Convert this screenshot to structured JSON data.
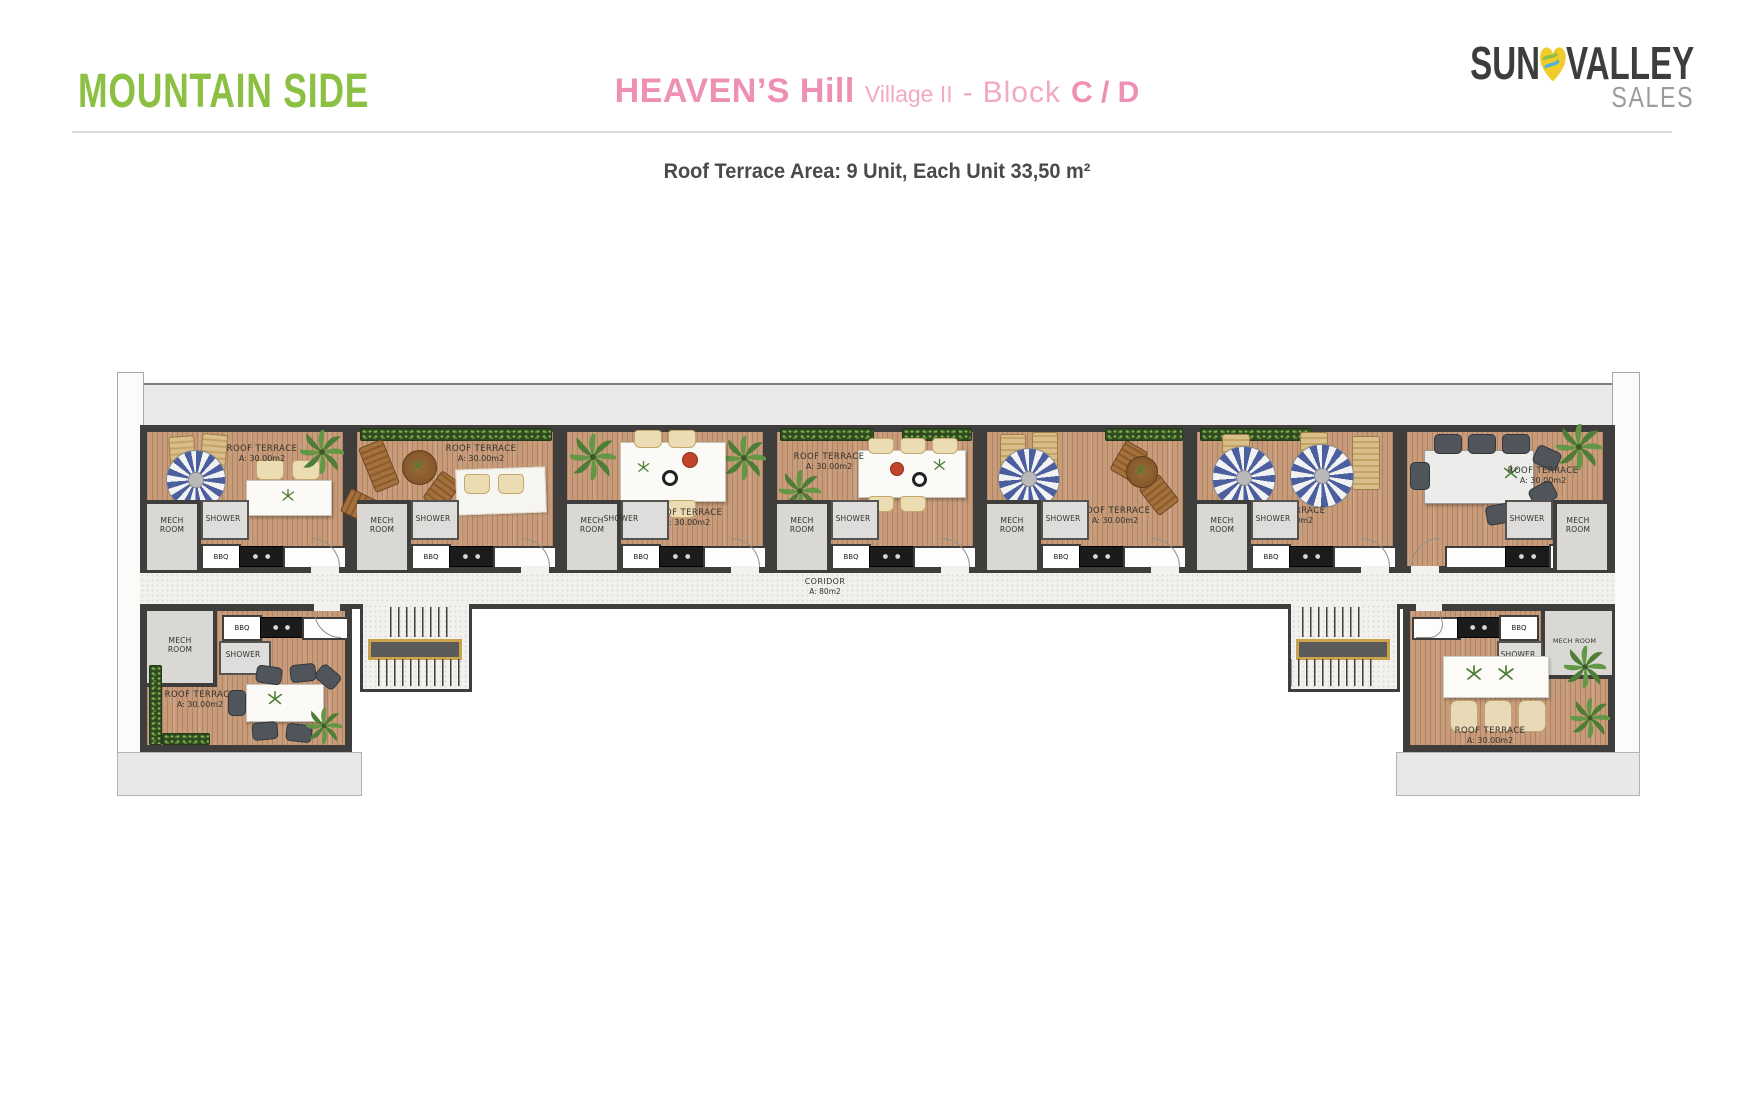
{
  "header": {
    "side_label": "MOUNTAIN SIDE",
    "title": {
      "project": "HEAVEN’S Hill",
      "village": "Village II",
      "dash": "-",
      "block_word": "Block",
      "block_value": "C / D"
    },
    "subtitle": "Roof Terrace Area: 9 Unit, Each Unit 33,50 m²",
    "logo": {
      "sun": "SUN",
      "valley": "VALLEY",
      "sales": "SALES"
    }
  },
  "plan": {
    "labels": {
      "roof_terrace": "ROOF TERRACE",
      "unit_area": "A: 30.00m2",
      "mech": "MECH",
      "room": "ROOM",
      "mech_room": "MECH ROOM",
      "shower": "SHOWER",
      "bbq": "BBQ"
    },
    "corridor": {
      "name": "CORIDOR",
      "area": "A: 80m2"
    }
  },
  "colors": {
    "accent_green": "#8cc043",
    "accent_pink": "#ee8fb4",
    "pink_light": "#f3a9c4",
    "wall_dark": "#3f3e3d",
    "wood": "#c89c7a",
    "logo_dark": "#3d3d3c",
    "logo_gray": "#9c9c9c",
    "heart_yellow": "#f0cc2b",
    "heart_green": "#8cc043",
    "heart_blue": "#4fb3d9",
    "umbrella_blue": "#4b5f9e"
  }
}
